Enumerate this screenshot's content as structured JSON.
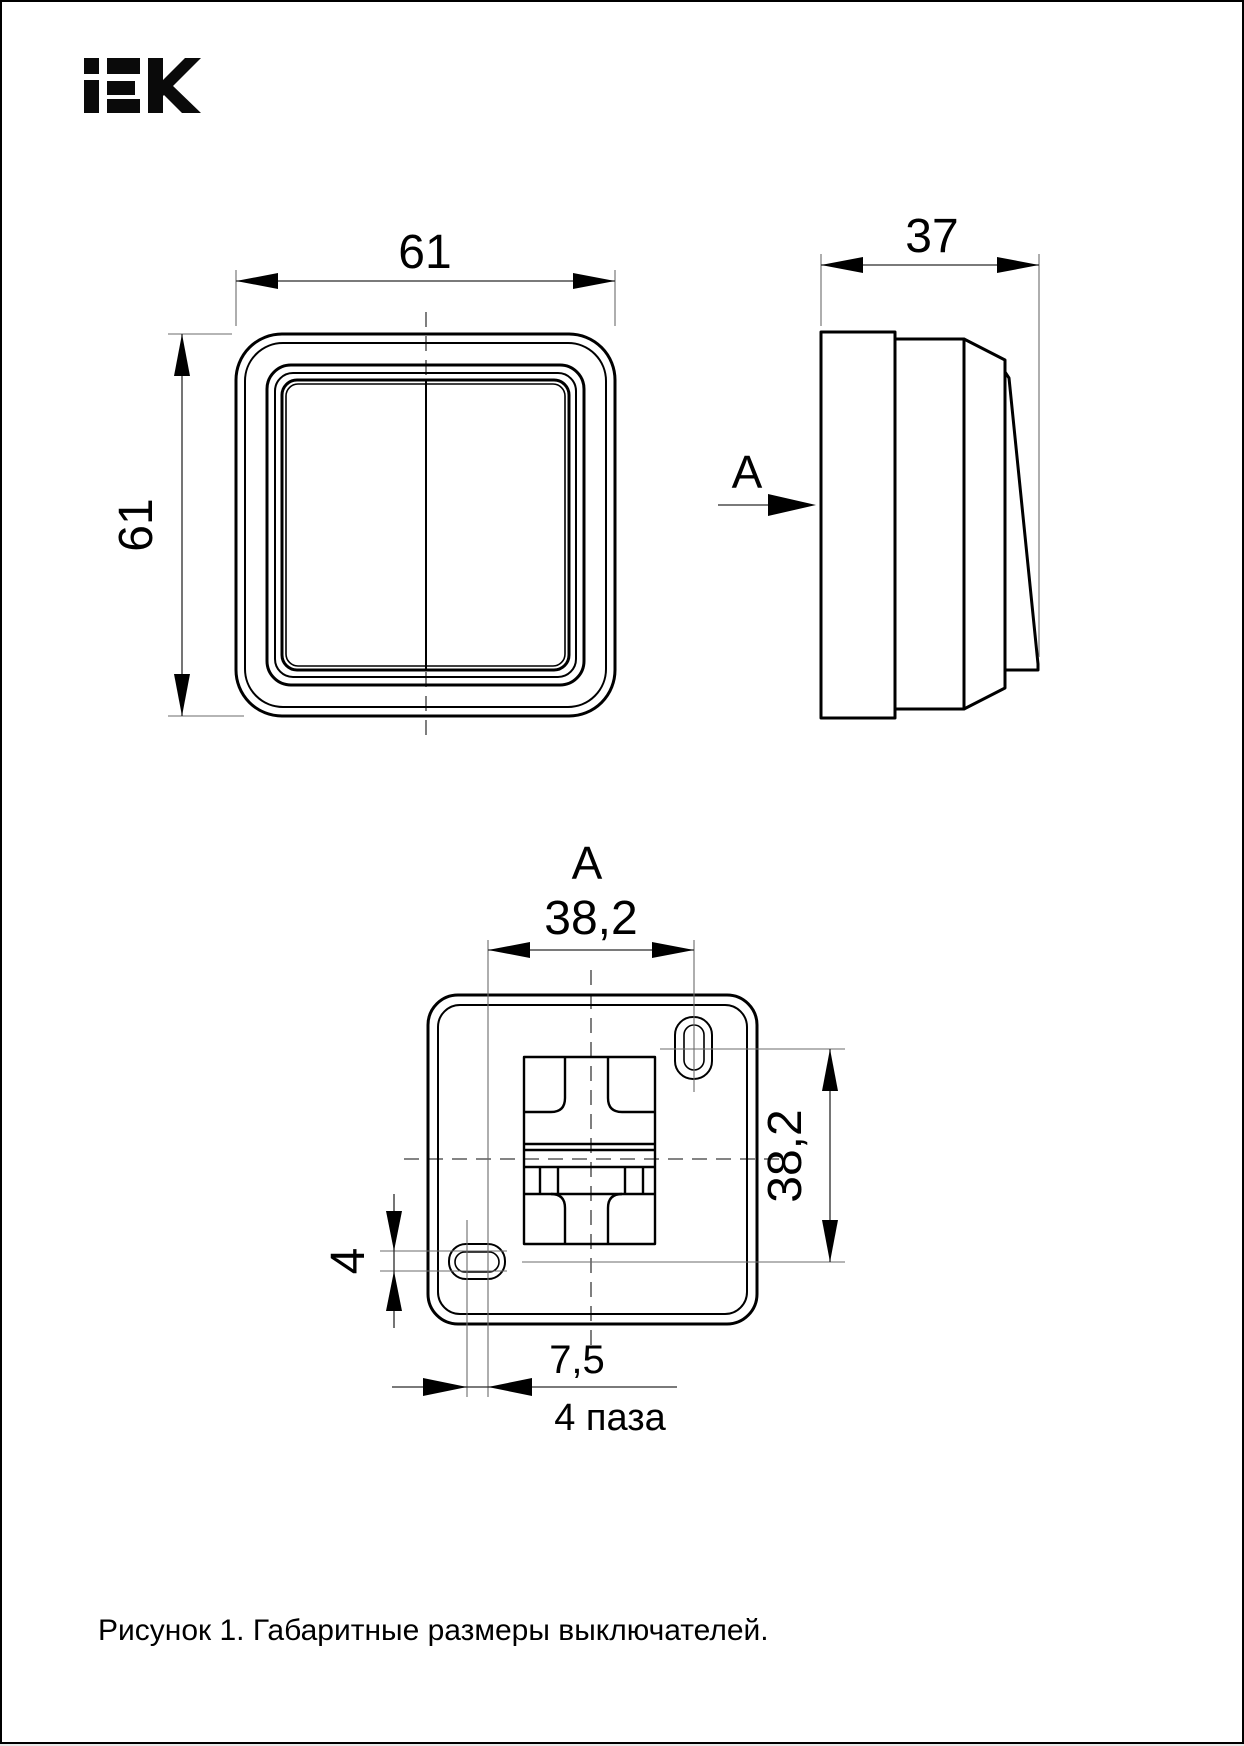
{
  "logo": {
    "brand": "IEK"
  },
  "front_view": {
    "width_mm": "61",
    "height_mm": "61"
  },
  "side_view": {
    "depth_mm": "37",
    "section_label": "А"
  },
  "bottom_view": {
    "view_label": "А",
    "hole_spacing_horizontal_mm": "38,2",
    "hole_spacing_vertical_mm": "38,2",
    "slot_width_mm": "4",
    "slot_edge_offset_mm": "7,5",
    "slots_count_note": "4 паза"
  },
  "caption": "Рисунок 1. Габаритные размеры выключателей."
}
